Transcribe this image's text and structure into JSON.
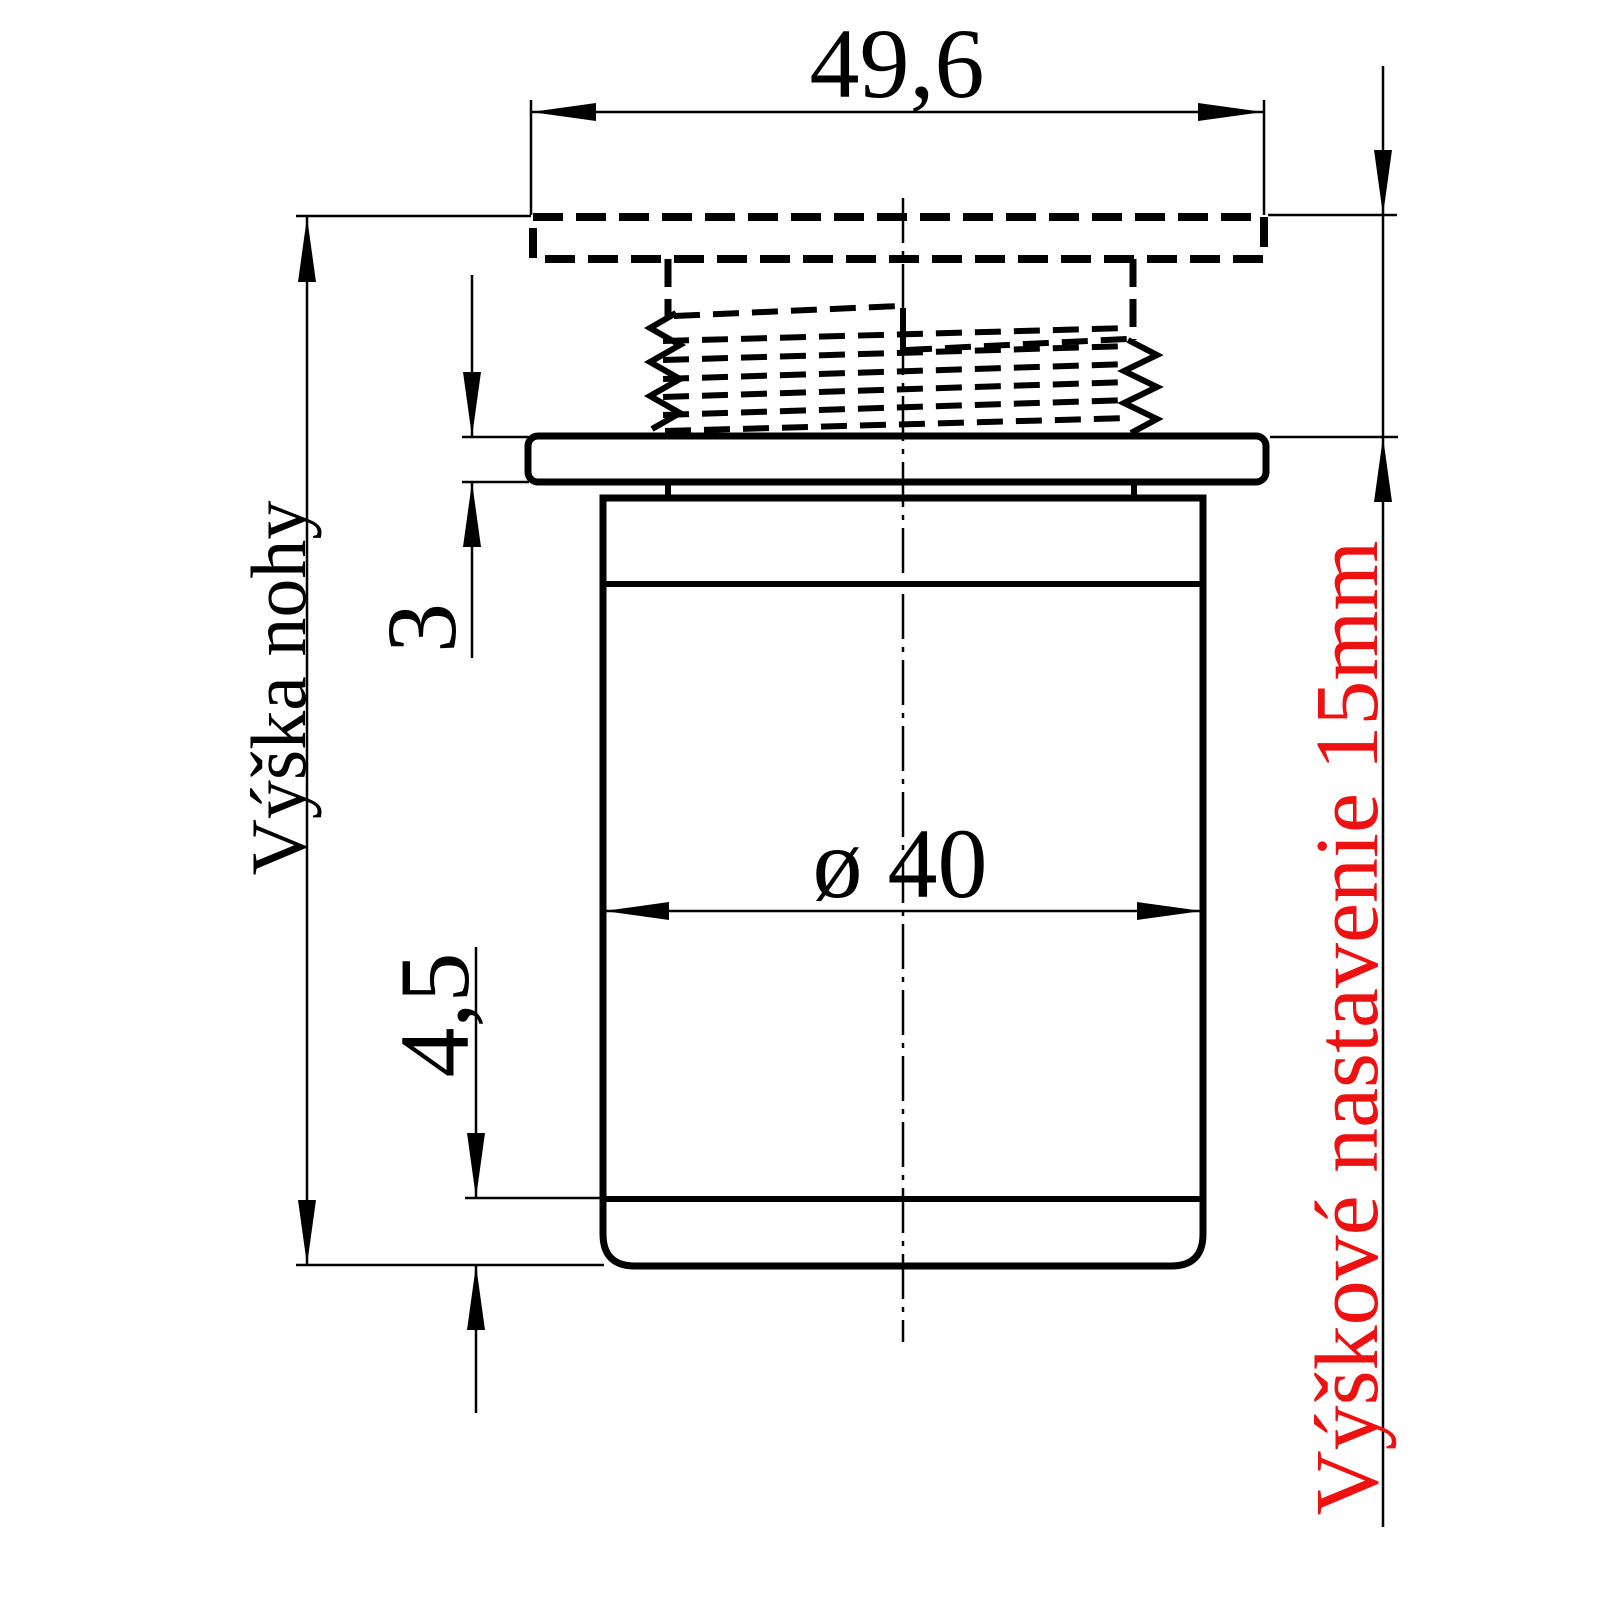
{
  "labels": {
    "width_top": "49,6",
    "leg_height": "Výška nohy",
    "flange_thickness": "3",
    "bottom_cap": "4,5",
    "diameter": "ø 40",
    "adjustment_note": "Výškové nastavenie 15mm"
  },
  "colors": {
    "line": "#000000",
    "background": "#ffffff",
    "note_red": "#ee1111"
  }
}
